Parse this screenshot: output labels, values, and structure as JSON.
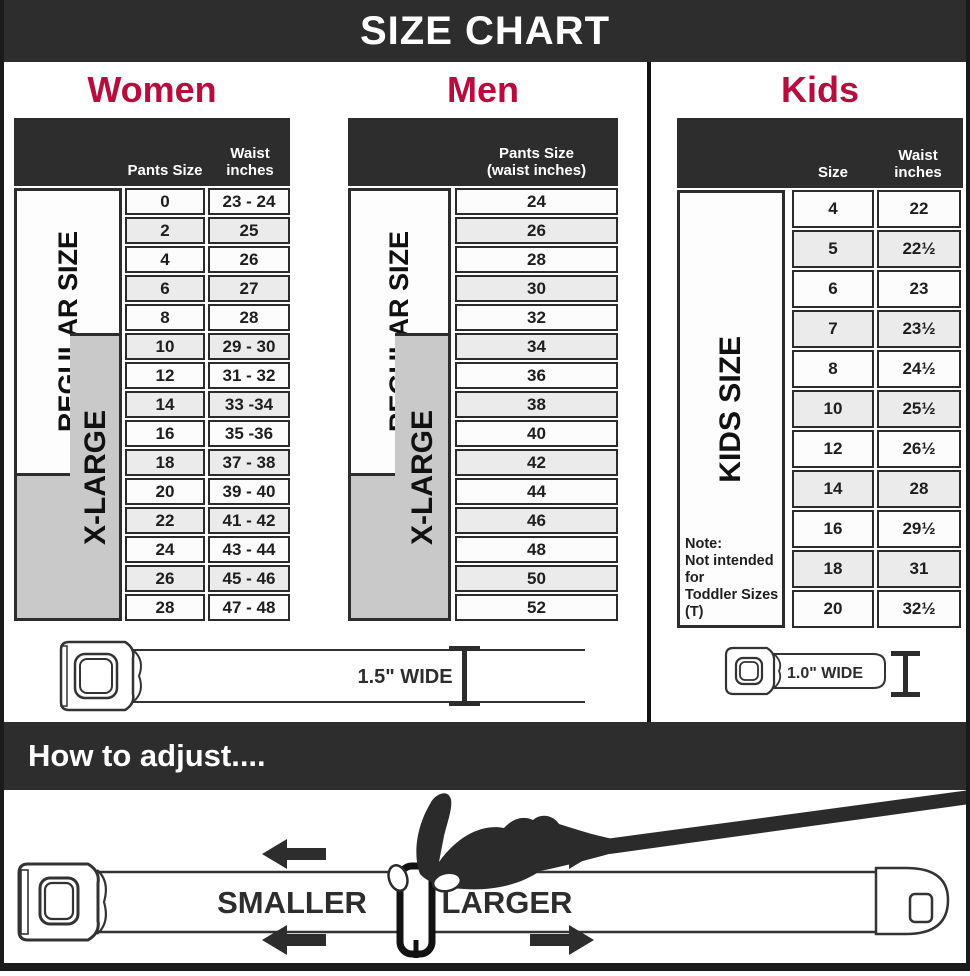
{
  "title": "SIZE CHART",
  "colors": {
    "accent": "#b80c3c",
    "dark": "#2d2d2d",
    "xlarge_gray": "#c9c9c9",
    "row_alt": "#ebebeb"
  },
  "sections": {
    "women": {
      "title": "Women",
      "col_pants": "Pants Size",
      "col_waist": "Waist inches",
      "regular_label": "REGULAR SIZE",
      "xlarge_label": "X-LARGE",
      "rows": [
        [
          "0",
          "23 - 24"
        ],
        [
          "2",
          "25"
        ],
        [
          "4",
          "26"
        ],
        [
          "6",
          "27"
        ],
        [
          "8",
          "28"
        ],
        [
          "10",
          "29 - 30"
        ],
        [
          "12",
          "31 - 32"
        ],
        [
          "14",
          "33 -34"
        ],
        [
          "16",
          "35 -36"
        ],
        [
          "18",
          "37 - 38"
        ],
        [
          "20",
          "39 - 40"
        ],
        [
          "22",
          "41 - 42"
        ],
        [
          "24",
          "43 - 44"
        ],
        [
          "26",
          "45 - 46"
        ],
        [
          "28",
          "47 - 48"
        ]
      ],
      "belt_width_label": "1.5\" WIDE"
    },
    "men": {
      "title": "Men",
      "col_line1": "Pants Size",
      "col_line2": "(waist inches)",
      "regular_label": "REGULAR SIZE",
      "xlarge_label": "X-LARGE",
      "rows": [
        "24",
        "26",
        "28",
        "30",
        "32",
        "34",
        "36",
        "38",
        "40",
        "42",
        "44",
        "46",
        "48",
        "50",
        "52"
      ]
    },
    "kids": {
      "title": "Kids",
      "col_size": "Size",
      "col_waist": "Waist inches",
      "side_label": "KIDS SIZE",
      "note_line1": "Note:",
      "note_line2": "Not intended for",
      "note_line3": "Toddler Sizes (T)",
      "rows": [
        [
          "4",
          "22"
        ],
        [
          "5",
          "22½"
        ],
        [
          "6",
          "23"
        ],
        [
          "7",
          "23½"
        ],
        [
          "8",
          "24½"
        ],
        [
          "10",
          "25½"
        ],
        [
          "12",
          "26½"
        ],
        [
          "14",
          "28"
        ],
        [
          "16",
          "29½"
        ],
        [
          "18",
          "31"
        ],
        [
          "20",
          "32½"
        ]
      ],
      "belt_width_label": "1.0\" WIDE"
    }
  },
  "adjust": {
    "heading": "How to adjust....",
    "smaller_label": "SMALLER",
    "larger_label": "LARGER"
  }
}
